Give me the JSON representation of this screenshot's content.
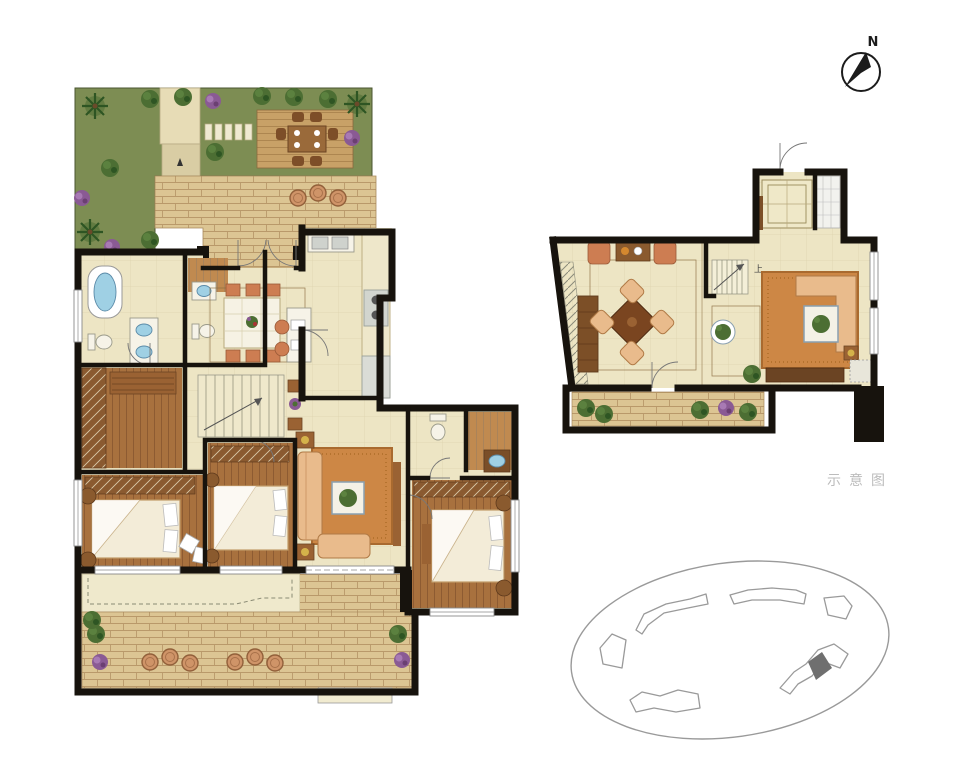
{
  "compass": {
    "label": "N"
  },
  "caption": {
    "text": "示意图"
  },
  "upper_plan": {
    "stair_label": "上"
  },
  "colors": {
    "bg": "#ffffff",
    "wall": "#17130d",
    "grass": "#7d8d53",
    "tree": "#4c6e33",
    "tree_light": "#5d8340",
    "tree_dark": "#2e5523",
    "flower": "#8a5a94",
    "flower_light": "#a87ab4",
    "trunk": "#6b4a2a",
    "deck": "#c8a167",
    "deck_line": "#a67f4a",
    "path": "#e7dcb6",
    "path_dark": "#d9cda4",
    "brick": "#dcc593",
    "brick_line": "#b9996a",
    "floor": "#ede5c4",
    "floor_line": "#cfc49a",
    "frame_line": "#8a6b3f",
    "wood": "#a8713e",
    "wood_dark": "#8a5830",
    "wood_light": "#c08a50",
    "cabinet": "#7c4f27",
    "shelf": "#9a6233",
    "rug": "#cd8745",
    "rug_dark": "#a96a2f",
    "sofa": "#e9bb8c",
    "chair": "#cd7d52",
    "bedding": "#f3ecd8",
    "bed_line": "#c19b68",
    "fixture": "#f6f3e8",
    "fixture_line": "#9a9a8a",
    "water": "#9fd0e4",
    "water_line": "#5a8aa8",
    "appl": "#d2d5cf",
    "appl_dark": "#9aa09a",
    "clay": "#cf9468",
    "clay_line": "#92603a",
    "site": "#9a9a9a",
    "site_dark": "#6f6f6f",
    "caption": "#bcbcbc",
    "compass": "#1c1c1c",
    "label": "#444444"
  }
}
